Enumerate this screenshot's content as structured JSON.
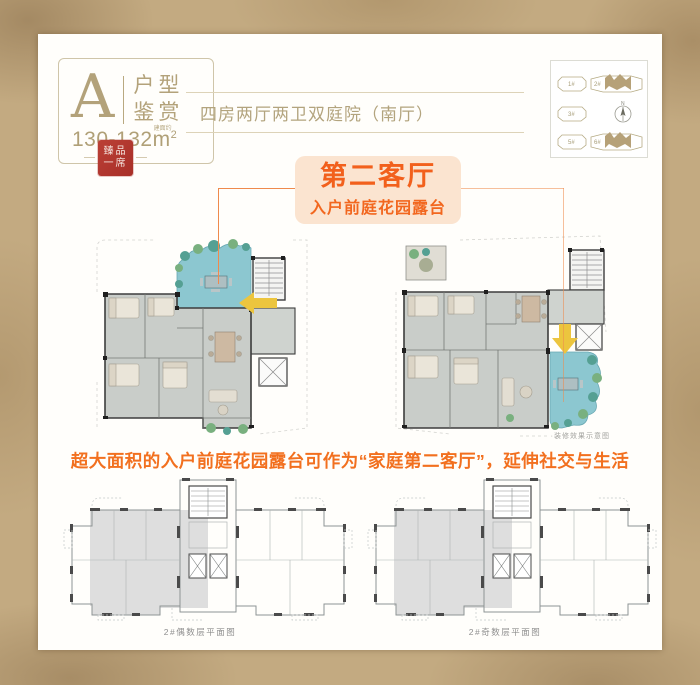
{
  "colors": {
    "accent_orange": "#f2671f",
    "tan": "#b0a077",
    "seal_red": "#b5352c",
    "terrace_teal": "#8cc7d0",
    "arrow_yellow": "#ecc53e",
    "parchment": "#c3aa81"
  },
  "badge": {
    "letter": "A",
    "title_line1": "户型",
    "title_line2": "鉴赏",
    "area_value": "130-132",
    "area_note": "建面约",
    "area_unit_base": "m",
    "area_unit_sup": "2",
    "seal_line1": "臻品",
    "seal_line2": "一席"
  },
  "header": {
    "text": "四房两厅两卫双庭院（南厅）"
  },
  "siteplan": {
    "compass_label": "N",
    "buildings": [
      {
        "label": "1#",
        "highlight": false
      },
      {
        "label": "2#",
        "highlight": true
      },
      {
        "label": "3#",
        "highlight": false
      },
      {
        "label": "5#",
        "highlight": false
      },
      {
        "label": "6#",
        "highlight": true
      }
    ]
  },
  "callout": {
    "watermark": "THE GRAND AGE",
    "title": "第二客厅",
    "subtitle": "入户前庭花园露台"
  },
  "plan_note": {
    "text": "·装修效果示意图"
  },
  "slogan": {
    "text": "超大面积的入户前庭花园露台可作为“家庭第二客厅”，延伸社交与生活"
  },
  "bottom": {
    "left_caption": "2#偶数层平面图",
    "right_caption": "2#奇数层平面图"
  }
}
